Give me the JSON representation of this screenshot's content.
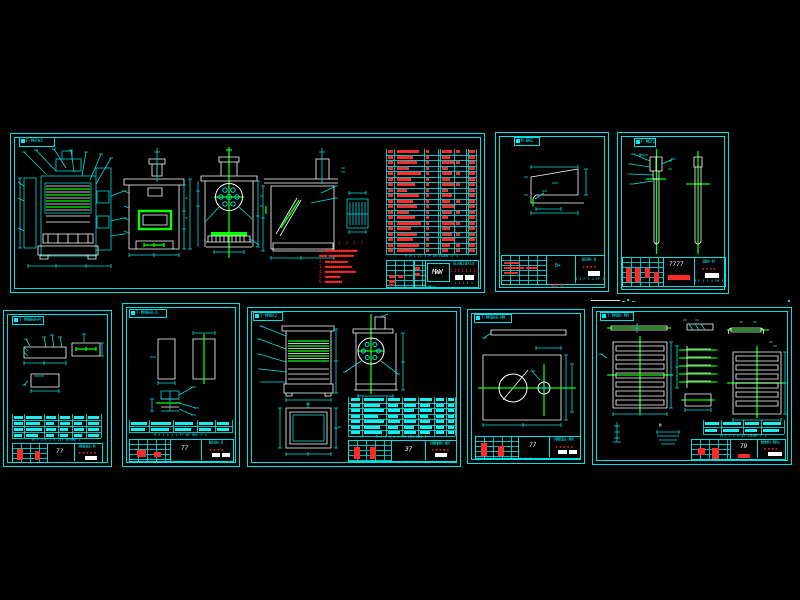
{
  "background": "#000000",
  "palette": {
    "cyan": "#00e0e0",
    "white": "#ffffff",
    "green": "#00ff00",
    "red": "#ff2a2a"
  },
  "s1": {
    "label": "F-MBYW2",
    "bottom_label": "WMWr",
    "logo": "MWW",
    "code": "SLHB20X14",
    "red_ticks": "1 1 1 1 1 1 1 1",
    "tick_row": "M M 1 II 1 M 1M PA4MF-E 4",
    "notes_title": "7 7 7 7",
    "notes": [
      "1. ●●●●●●●●●●●●●●●●●",
      "●●●●-●●●●●●●●●●●●●",
      "2. ●●●●●●●●●●●●",
      "3. ●●●●●●●●●●●●●●",
      "4. ●●●●●●●●●●●●●●●●",
      "5. ●●●●●●●●",
      "6. ●●●●●●●●●"
    ],
    "bom": {
      "rowH": 5.5,
      "blobH": 3,
      "color": "#ff2a2a",
      "rowLine": 1,
      "cols": [
        2,
        11,
        40,
        56,
        70,
        83
      ],
      "vlines": [
        0,
        8,
        38,
        52,
        54,
        68,
        80,
        82,
        90
      ],
      "rows": [
        [
          5,
          22,
          3,
          10,
          4,
          6
        ],
        [
          5,
          16,
          3,
          8,
          0,
          6
        ],
        [
          5,
          20,
          3,
          12,
          4,
          6
        ],
        [
          5,
          12,
          3,
          6,
          0,
          6
        ],
        [
          5,
          24,
          3,
          10,
          4,
          6
        ],
        [
          5,
          14,
          3,
          8,
          0,
          6
        ],
        [
          5,
          18,
          3,
          12,
          4,
          6
        ],
        [
          5,
          10,
          3,
          6,
          0,
          6
        ],
        [
          5,
          22,
          3,
          10,
          0,
          6
        ],
        [
          5,
          16,
          3,
          8,
          4,
          6
        ],
        [
          5,
          20,
          3,
          12,
          0,
          6
        ],
        [
          5,
          12,
          3,
          10,
          4,
          6
        ],
        [
          5,
          18,
          3,
          6,
          0,
          6
        ],
        [
          5,
          24,
          3,
          12,
          4,
          6
        ],
        [
          5,
          14,
          3,
          8,
          0,
          6
        ],
        [
          5,
          20,
          3,
          10,
          4,
          6
        ],
        [
          5,
          16,
          3,
          12,
          0,
          6
        ],
        [
          5,
          22,
          3,
          8,
          4,
          6
        ],
        [
          5,
          18,
          3,
          6,
          4,
          6
        ]
      ]
    }
  },
  "s2": {
    "label": "M-BW2",
    "number": "B+",
    "code": "B88H-8",
    "red_ticks": "▪ ▪ ▪ ▪",
    "bottom_red": "8888-88",
    "tick_row": "M 1 F 1 1 FF 1"
  },
  "s3": {
    "label": "F-MBY2",
    "number": "7777",
    "code": "BB8-M",
    "red_ticks": "▪ ▪ ▪ ▪",
    "tick_row": "M F 1 1 1 FM 1"
  },
  "s4": {
    "label": "T-MMBH8+M",
    "number": "7?",
    "code": "MMBH8-M",
    "red_ticks": "▪ ▪ ▪ ▪ ▪",
    "tick_row": "M F 1 F 1 F 1FF MFMMF 1",
    "table": {
      "rowH": 6,
      "blobH": 3,
      "color": "#19eded",
      "rowLine": 1,
      "cols": [
        2,
        14,
        34,
        48,
        62,
        76
      ],
      "vlines": [
        0,
        12,
        32,
        46,
        60,
        74,
        89
      ],
      "rows": [
        [
          9,
          16,
          10,
          10,
          10,
          11
        ],
        [
          9,
          14,
          8,
          10,
          8,
          11
        ],
        [
          9,
          16,
          10,
          8,
          10,
          11
        ],
        [
          8,
          12,
          8,
          8,
          8,
          11
        ]
      ]
    }
  },
  "s5": {
    "label": "T-MMBHB-D",
    "number": "77",
    "code": "NBUH-D",
    "red_ticks": "▪ ▪ ▪ ▪",
    "tick_row": "M 5 1 1 1 1 FF MP MHL P 1",
    "under_ticks": "7 7",
    "table": {
      "rowH": 6,
      "blobH": 3,
      "color": "#19eded",
      "rowLine": 1,
      "cols": [
        2,
        22,
        46,
        70,
        88
      ],
      "vlines": [
        0,
        20,
        44,
        68,
        86,
        103
      ],
      "rows": [
        [
          16,
          20,
          18,
          14,
          12
        ],
        [
          14,
          18,
          16,
          12,
          12
        ]
      ]
    }
  },
  "s6": {
    "label": "T-MMBX2",
    "number": "37",
    "code": "MMMMM-MM",
    "red_ticks": "▪ ▪ ▪ ▪ ▪",
    "tick_row": "M 1 F 1 1 1 FM IM1 MM1 1",
    "under_ticks": "7 7",
    "table": {
      "rowH": 5.5,
      "blobH": 3,
      "color": "#19eded",
      "rowLine": 1,
      "cols": [
        3,
        16,
        40,
        56,
        72,
        88,
        100
      ],
      "vlines": [
        0,
        14,
        38,
        54,
        70,
        86,
        98,
        107
      ],
      "rows": [
        [
          9,
          20,
          12,
          12,
          12,
          8,
          6
        ],
        [
          9,
          16,
          10,
          12,
          10,
          8,
          6
        ],
        [
          9,
          20,
          12,
          10,
          12,
          8,
          6
        ],
        [
          9,
          14,
          10,
          12,
          8,
          8,
          6
        ],
        [
          9,
          20,
          12,
          12,
          10,
          8,
          6
        ],
        [
          9,
          16,
          10,
          10,
          12,
          8,
          6
        ],
        [
          9,
          18,
          12,
          12,
          10,
          8,
          6
        ]
      ]
    }
  },
  "s7": {
    "label": "T-MMBH8-MM",
    "number": "77",
    "code": "MMBB4-MM",
    "red_ticks": "▪ ▪ ▪ ▪ ▪",
    "tick_row": "7 7"
  },
  "s8": {
    "label": "T-MMBH-MM",
    "number": "79",
    "code": "MMMM-MMs",
    "red_ticks": "▪ ▪ ▪ ▪",
    "tick_row": "M F 1 F E 1F TM1MF F 1",
    "m_label": "M",
    "table": {
      "rowH": 7,
      "blobH": 3,
      "color": "#19eded",
      "rowLine": 1,
      "cols": [
        2,
        20,
        42,
        60
      ],
      "vlines": [
        0,
        18,
        40,
        58,
        81
      ],
      "rows": [
        [
          14,
          18,
          14,
          18
        ],
        [
          12,
          16,
          12,
          16
        ]
      ]
    }
  }
}
